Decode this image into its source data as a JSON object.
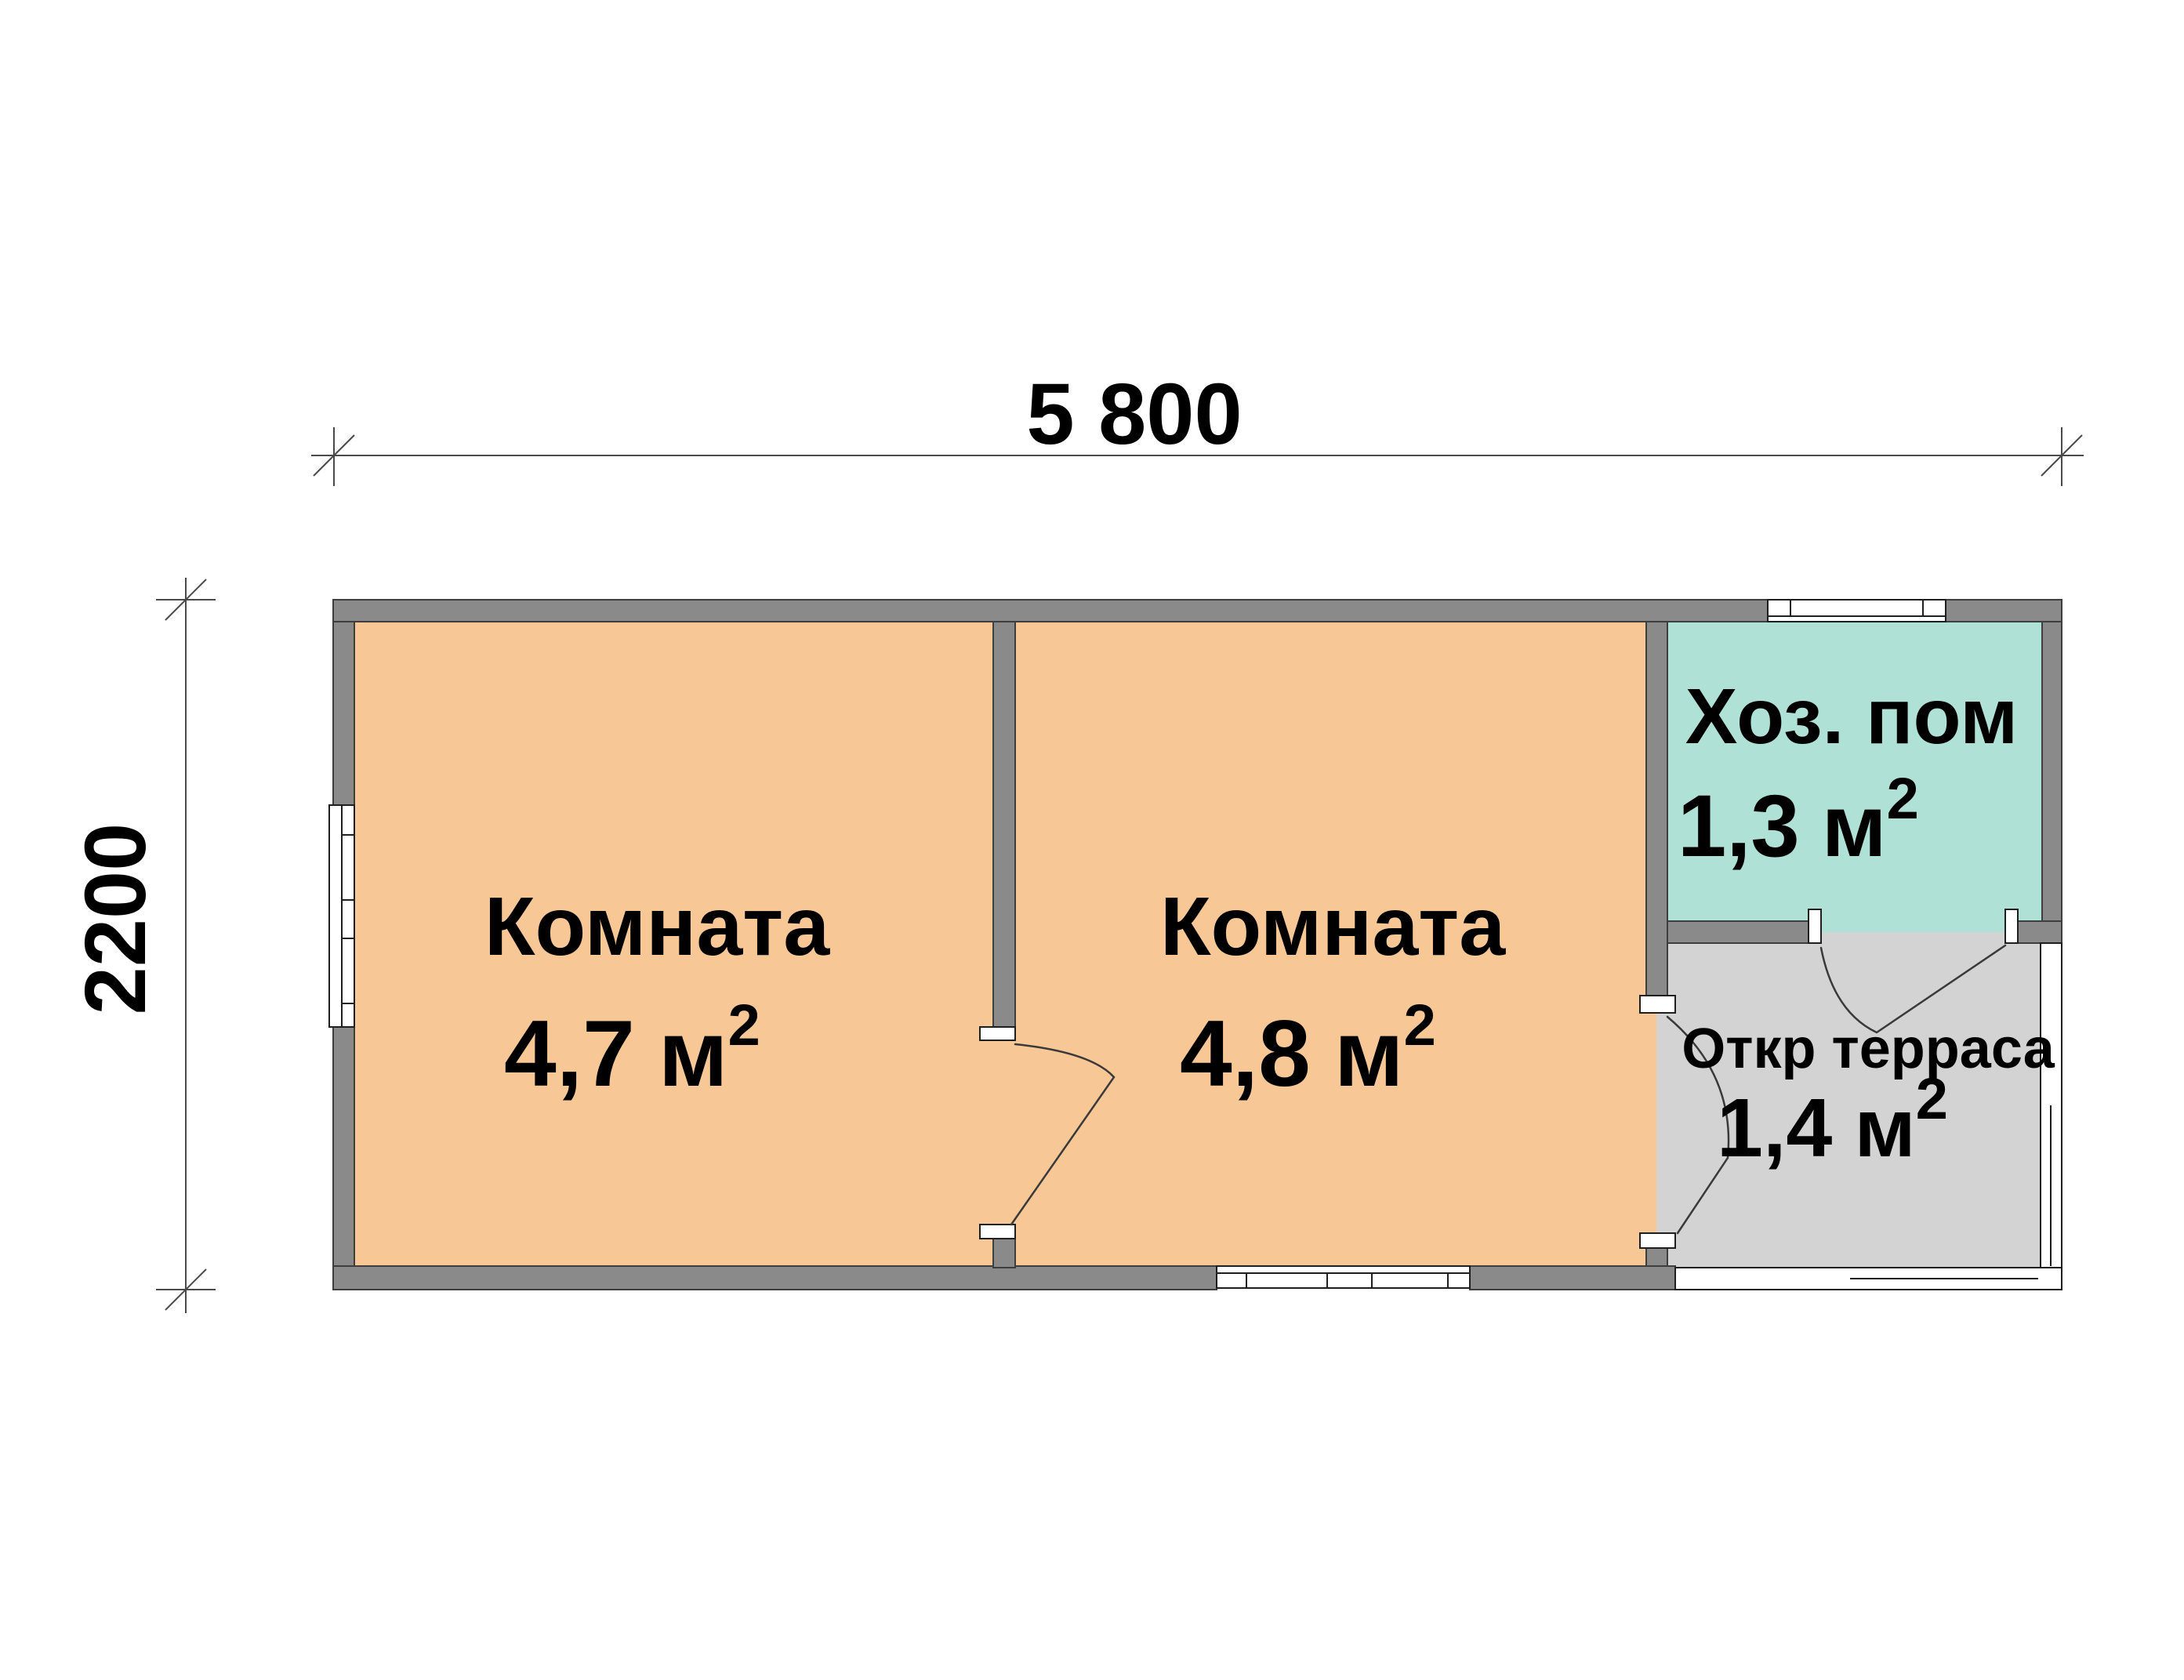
{
  "plan": {
    "type": "floor-plan",
    "dimensions": {
      "width_label": "5 800",
      "height_label": "2200"
    },
    "rooms": [
      {
        "id": "room-1",
        "name": "Комната",
        "area_value": "4,7"
      },
      {
        "id": "room-2",
        "name": "Комната",
        "area_value": "4,8"
      },
      {
        "id": "utility",
        "name": "Хоз. пом",
        "area_value": "1,3"
      },
      {
        "id": "terrace",
        "name": "Откр терраса",
        "area_value": "1,4"
      }
    ],
    "units": {
      "area_unit": "м",
      "area_superscript": "2"
    },
    "colors": {
      "room_fill": "#F7C795",
      "utility_fill": "#AFE1D6",
      "terrace_fill": "#D3D3D3",
      "wall_fill": "#8A8A8A"
    }
  }
}
